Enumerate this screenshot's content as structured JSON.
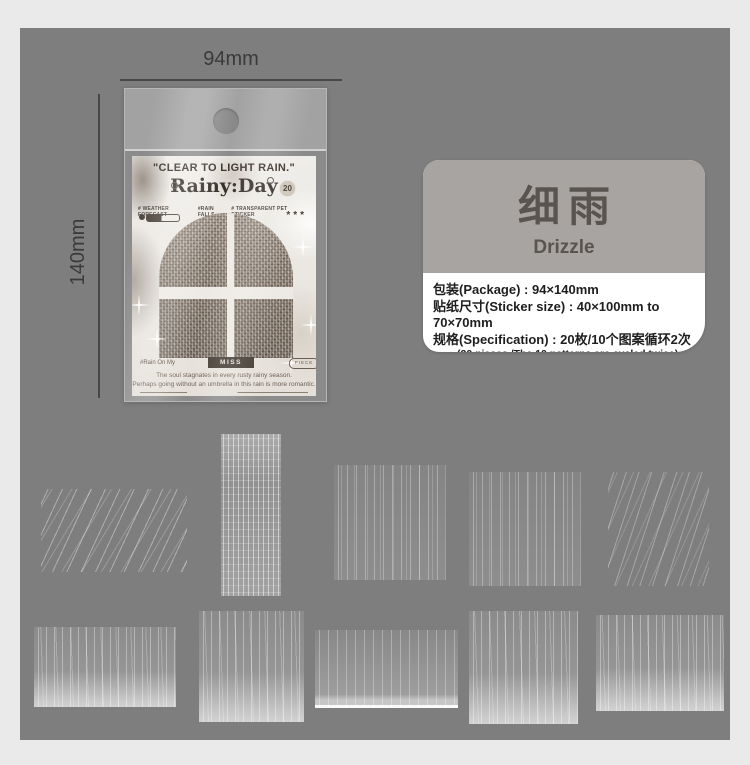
{
  "colors": {
    "board": "#7e7e7e",
    "background": "#eaeaea",
    "card_badge_dark": "#453d35",
    "info_header": "#a7a4a1"
  },
  "dimensions": {
    "width_label": "94mm",
    "height_label": "140mm"
  },
  "package": {
    "quote": "\"CLEAR TO LIGHT RAIN.\"",
    "brand": "Rainy:Day",
    "count_badge": "20",
    "tags": [
      "# WEATHER FORECAST",
      "#RAIN FALLS",
      "# TRANSPARENT PET STICKER"
    ],
    "stars": "***",
    "footer": {
      "hashtag": "#Rain On My",
      "badge": "MISS TIME",
      "pill": "PIECE"
    },
    "caption": [
      "The soul stagnates in every rusty rainy season.",
      "Perhaps going without an umbrella in this rain is more romantic."
    ]
  },
  "info_card": {
    "title_cn": "细雨",
    "title_en": "Drizzle",
    "specs": [
      "包装(Package) : 94×140mm",
      "贴纸尺寸(Sticker size) : 40×100mm to 70×70mm",
      "规格(Specification) : 20枚/10个图案循环2次"
    ],
    "note": "(20 pieces /The 10 patterns are cycled twice)"
  }
}
